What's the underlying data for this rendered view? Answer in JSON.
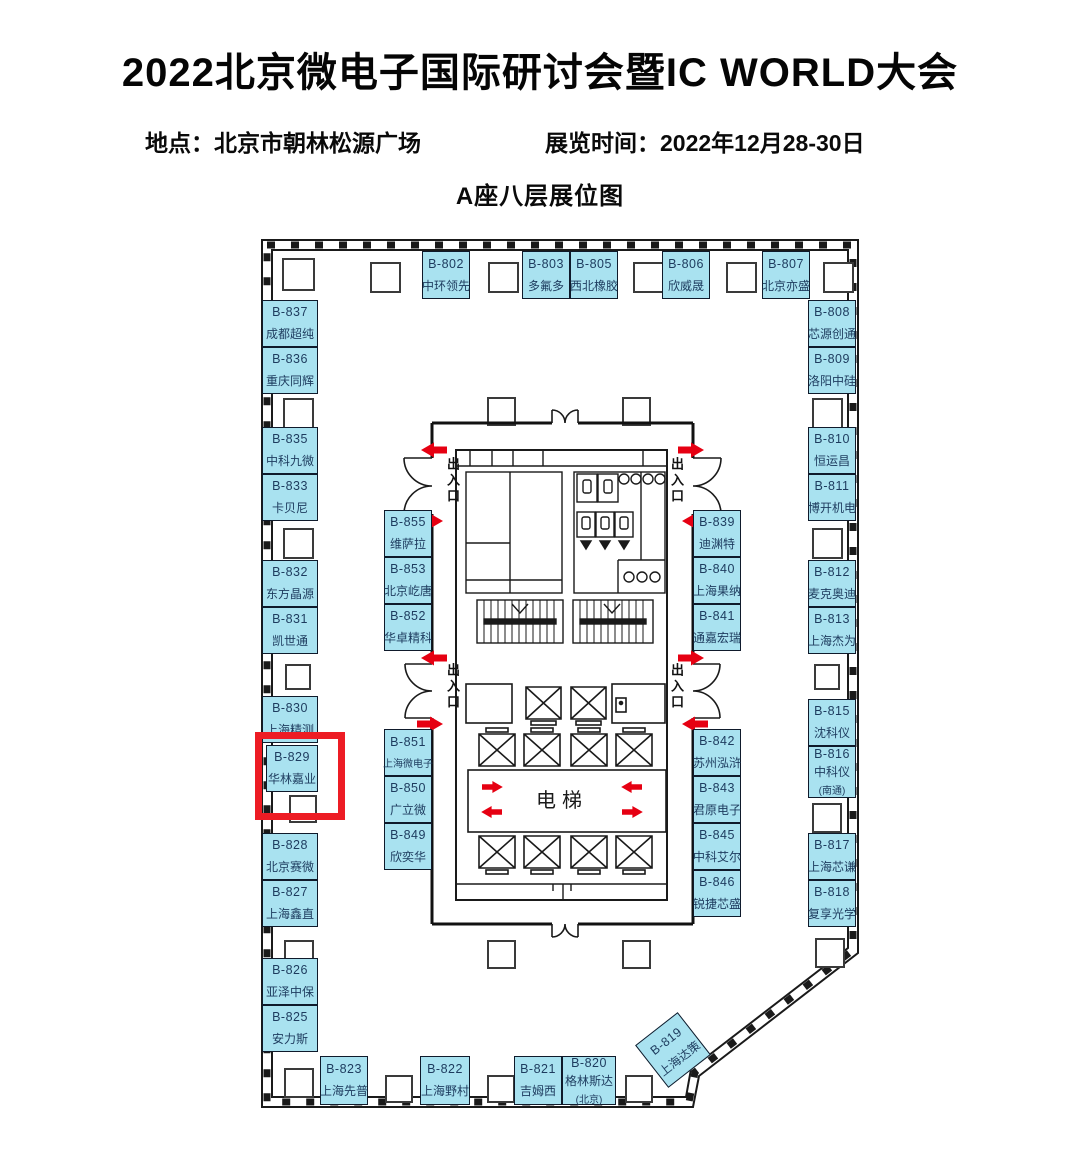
{
  "header": {
    "title": "2022北京微电子国际研讨会暨IC WORLD大会",
    "location": "地点：北京市朝林松源广场",
    "time": "展览时间：2022年12月28-30日",
    "map_title": "A座八层展位图"
  },
  "labels": {
    "elevator": "电梯",
    "entrance": "出入口"
  },
  "highlight": {
    "booth_id": "B-829"
  },
  "colors": {
    "booth_fill": "#A9E2F0",
    "booth_border": "#0F1A2B",
    "booth_text": "#1D3B5E",
    "highlight_red": "#ED1C24",
    "arrow_red": "#E60012",
    "wall": "#1A1A1A"
  },
  "booths": [
    {
      "id": "B-802",
      "name": "中环领先",
      "x": 422,
      "y": 251,
      "w": 48,
      "h": 48
    },
    {
      "id": "B-803",
      "name": "多氟多",
      "x": 522,
      "y": 251,
      "w": 48,
      "h": 48
    },
    {
      "id": "B-805",
      "name": "西北橡胶",
      "x": 570,
      "y": 251,
      "w": 48,
      "h": 48
    },
    {
      "id": "B-806",
      "name": "欣威晟",
      "x": 662,
      "y": 251,
      "w": 48,
      "h": 48
    },
    {
      "id": "B-807",
      "name": "北京亦盛",
      "x": 762,
      "y": 251,
      "w": 48,
      "h": 48
    },
    {
      "id": "B-837",
      "name": "成都超纯",
      "x": 262,
      "y": 300,
      "w": 56,
      "h": 47
    },
    {
      "id": "B-836",
      "name": "重庆同辉",
      "x": 262,
      "y": 347,
      "w": 56,
      "h": 47
    },
    {
      "id": "B-835",
      "name": "中科九微",
      "x": 262,
      "y": 427,
      "w": 56,
      "h": 47
    },
    {
      "id": "B-833",
      "name": "卡贝尼",
      "x": 262,
      "y": 474,
      "w": 56,
      "h": 47
    },
    {
      "id": "B-832",
      "name": "东方晶源",
      "x": 262,
      "y": 560,
      "w": 56,
      "h": 47
    },
    {
      "id": "B-831",
      "name": "凯世通",
      "x": 262,
      "y": 607,
      "w": 56,
      "h": 47
    },
    {
      "id": "B-830",
      "name": "上海精测",
      "x": 262,
      "y": 696,
      "w": 56,
      "h": 47
    },
    {
      "id": "B-829",
      "name": "华林嘉业",
      "x": 266,
      "y": 745,
      "w": 52,
      "h": 47
    },
    {
      "id": "B-828",
      "name": "北京赛微",
      "x": 262,
      "y": 833,
      "w": 56,
      "h": 47
    },
    {
      "id": "B-827",
      "name": "上海鑫直",
      "x": 262,
      "y": 880,
      "w": 56,
      "h": 47
    },
    {
      "id": "B-826",
      "name": "亚泽中保",
      "x": 262,
      "y": 958,
      "w": 56,
      "h": 47
    },
    {
      "id": "B-825",
      "name": "安力斯",
      "x": 262,
      "y": 1005,
      "w": 56,
      "h": 47
    },
    {
      "id": "B-823",
      "name": "上海先普",
      "x": 320,
      "y": 1056,
      "w": 48,
      "h": 49
    },
    {
      "id": "B-822",
      "name": "上海野村",
      "x": 420,
      "y": 1056,
      "w": 50,
      "h": 49
    },
    {
      "id": "B-821",
      "name": "吉姆西",
      "x": 514,
      "y": 1056,
      "w": 48,
      "h": 49
    },
    {
      "id": "B-820",
      "name": "格林斯达",
      "name2": "(北京)",
      "x": 562,
      "y": 1056,
      "w": 54,
      "h": 49
    },
    {
      "id": "B-819",
      "name": "上海达策",
      "x": 646,
      "y": 1023,
      "w": 54,
      "h": 54,
      "rot": -38
    },
    {
      "id": "B-808",
      "name": "芯源创通",
      "x": 808,
      "y": 300,
      "w": 48,
      "h": 47
    },
    {
      "id": "B-809",
      "name": "洛阳中硅",
      "x": 808,
      "y": 347,
      "w": 48,
      "h": 47
    },
    {
      "id": "B-810",
      "name": "恒运昌",
      "x": 808,
      "y": 427,
      "w": 48,
      "h": 47
    },
    {
      "id": "B-811",
      "name": "博开机电",
      "x": 808,
      "y": 474,
      "w": 48,
      "h": 47
    },
    {
      "id": "B-812",
      "name": "麦克奥迪",
      "x": 808,
      "y": 560,
      "w": 48,
      "h": 47
    },
    {
      "id": "B-813",
      "name": "上海杰为",
      "x": 808,
      "y": 607,
      "w": 48,
      "h": 47
    },
    {
      "id": "B-815",
      "name": "沈科仪",
      "x": 808,
      "y": 699,
      "w": 48,
      "h": 47
    },
    {
      "id": "B-816",
      "name": "中科仪",
      "name2": "(南通)",
      "x": 808,
      "y": 746,
      "w": 48,
      "h": 52
    },
    {
      "id": "B-817",
      "name": "上海芯谦",
      "x": 808,
      "y": 833,
      "w": 48,
      "h": 47
    },
    {
      "id": "B-818",
      "name": "复享光学",
      "x": 808,
      "y": 880,
      "w": 48,
      "h": 47
    },
    {
      "id": "B-855",
      "name": "维萨拉",
      "x": 384,
      "y": 510,
      "w": 48,
      "h": 47
    },
    {
      "id": "B-853",
      "name": "北京屹唐",
      "x": 384,
      "y": 557,
      "w": 48,
      "h": 47
    },
    {
      "id": "B-852",
      "name": "华卓精科",
      "x": 384,
      "y": 604,
      "w": 48,
      "h": 47
    },
    {
      "id": "B-851",
      "name": "上海微电子",
      "x": 384,
      "y": 729,
      "w": 48,
      "h": 47
    },
    {
      "id": "B-850",
      "name": "广立微",
      "x": 384,
      "y": 776,
      "w": 48,
      "h": 47
    },
    {
      "id": "B-849",
      "name": "欣奕华",
      "x": 384,
      "y": 823,
      "w": 48,
      "h": 47
    },
    {
      "id": "B-839",
      "name": "迪渊特",
      "x": 693,
      "y": 510,
      "w": 48,
      "h": 47
    },
    {
      "id": "B-840",
      "name": "上海果纳",
      "x": 693,
      "y": 557,
      "w": 48,
      "h": 47
    },
    {
      "id": "B-841",
      "name": "通嘉宏瑞",
      "x": 693,
      "y": 604,
      "w": 48,
      "h": 47
    },
    {
      "id": "B-842",
      "name": "苏州泓浒",
      "x": 693,
      "y": 729,
      "w": 48,
      "h": 47
    },
    {
      "id": "B-843",
      "name": "君原电子",
      "x": 693,
      "y": 776,
      "w": 48,
      "h": 47
    },
    {
      "id": "B-845",
      "name": "中科艾尔",
      "x": 693,
      "y": 823,
      "w": 48,
      "h": 47
    },
    {
      "id": "B-846",
      "name": "锐捷芯盛",
      "x": 693,
      "y": 870,
      "w": 48,
      "h": 47
    }
  ]
}
